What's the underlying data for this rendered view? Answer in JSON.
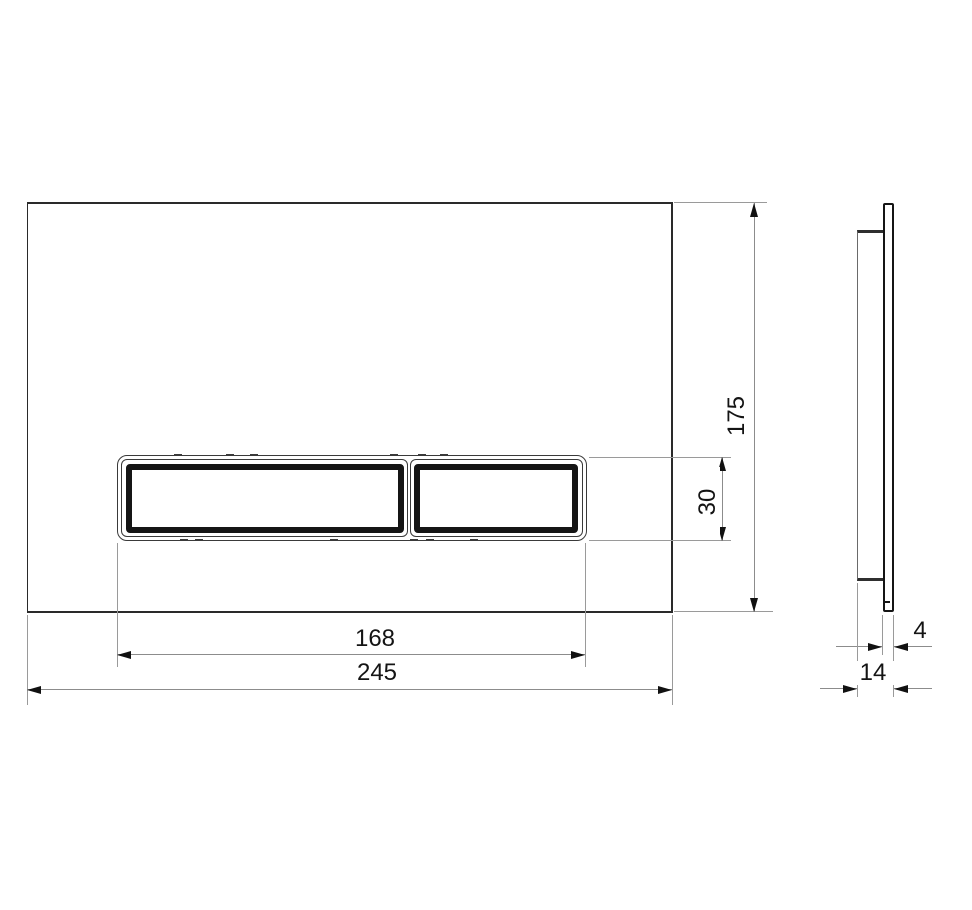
{
  "drawing": {
    "kind": "technical-dimension-drawing",
    "subject": "flush-plate-with-two-buttons",
    "views": {
      "front": "front-view",
      "side": "side-profile-view"
    },
    "dimensions": {
      "plate_height": {
        "value": "175",
        "unit": "mm",
        "orientation": "vertical"
      },
      "button_height": {
        "value": "30",
        "unit": "mm",
        "orientation": "vertical"
      },
      "button_width": {
        "value": "168",
        "unit": "mm",
        "orientation": "horizontal"
      },
      "plate_width": {
        "value": "245",
        "unit": "mm",
        "orientation": "horizontal"
      },
      "panel_thickness": {
        "value": "4",
        "unit": "mm",
        "orientation": "horizontal"
      },
      "total_depth": {
        "value": "14",
        "unit": "mm",
        "orientation": "horizontal"
      }
    },
    "colors": {
      "background": "#ffffff",
      "outline": "#2a2a2a",
      "button_frame": "#151515",
      "dimension_line": "#8c8c8c",
      "text": "#141414"
    }
  }
}
